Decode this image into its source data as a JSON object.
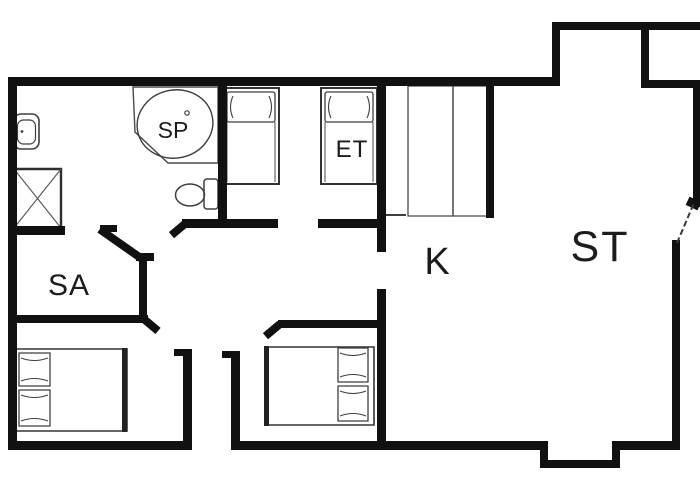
{
  "labels": {
    "bathtub": "SP",
    "bedroom_top": "ET",
    "kitchen": "K",
    "living_room": "ST",
    "sauna": "SA"
  },
  "colors": {
    "wall": "#111111",
    "furniture-line": "#3f3f3f",
    "label": "#1c1c1c",
    "background": "#ffffff"
  }
}
